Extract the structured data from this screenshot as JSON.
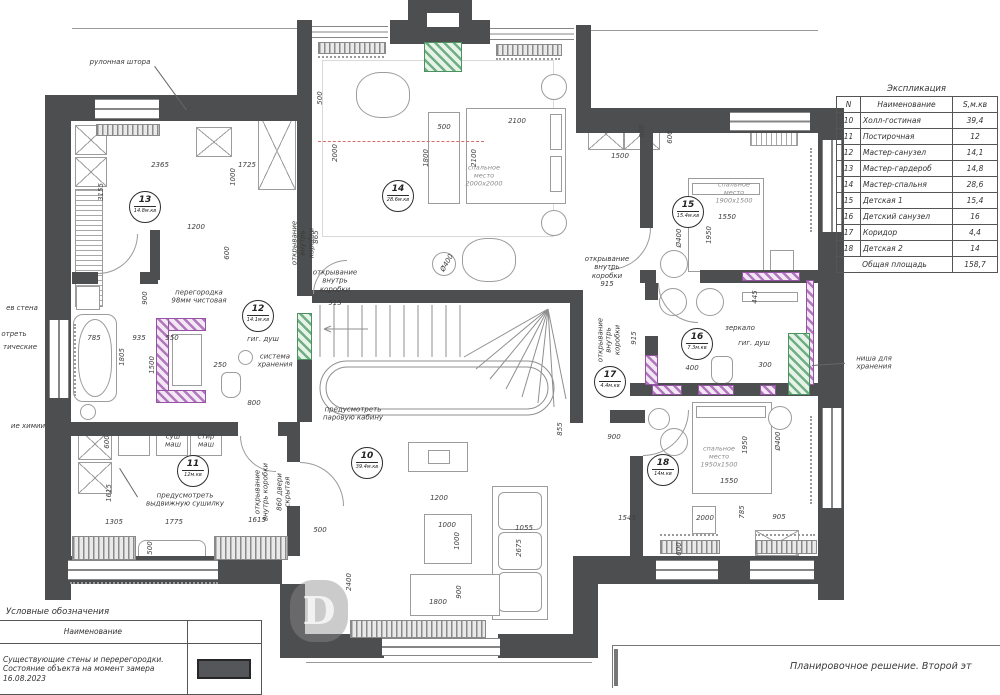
{
  "colors": {
    "wall": "#4d4e50",
    "new_partition": "#9454a3",
    "niche_green": "#4c9160",
    "centerline_red": "#d96b6b"
  },
  "explication": {
    "title": "Экспликация",
    "headers": [
      "N",
      "Наименование",
      "S,м.кв"
    ],
    "rows": [
      [
        "10",
        "Холл-гостиная",
        "39,4"
      ],
      [
        "11",
        "Постирочная",
        "12"
      ],
      [
        "12",
        "Мастер-санузел",
        "14,1"
      ],
      [
        "13",
        "Мастер-гардероб",
        "14,8"
      ],
      [
        "14",
        "Мастер-спальня",
        "28,6"
      ],
      [
        "15",
        "Детская 1",
        "15,4"
      ],
      [
        "16",
        "Детский санузел",
        "16"
      ],
      [
        "17",
        "Коридор",
        "4,4"
      ],
      [
        "18",
        "Детская 2",
        "14"
      ]
    ],
    "total_label": "Общая площадь",
    "total_value": "158,7"
  },
  "symbols_legend": {
    "title": "Условные обозначения",
    "header": "Наименование",
    "row_text": "Существующие стены и перерегородки. Состояние объекта на момент замера 16.08.2023"
  },
  "title_block": {
    "text": "Планировочное решение. Второй эт"
  },
  "plan": {
    "rooms": [
      {
        "n": "13",
        "a": "14.8м.кв",
        "x": 145,
        "y": 207
      },
      {
        "n": "12",
        "a": "14.1м.кв",
        "x": 258,
        "y": 316
      },
      {
        "n": "14",
        "a": "28.6м.кв",
        "x": 398,
        "y": 196
      },
      {
        "n": "15",
        "a": "15.4м.кв",
        "x": 688,
        "y": 212
      },
      {
        "n": "16",
        "a": "7.3м.кв",
        "x": 697,
        "y": 344
      },
      {
        "n": "17",
        "a": "4.4м.кв",
        "x": 610,
        "y": 382
      },
      {
        "n": "10",
        "a": "39.4м.кв",
        "x": 367,
        "y": 463
      },
      {
        "n": "11",
        "a": "12м.кв",
        "x": 193,
        "y": 471
      },
      {
        "n": "18",
        "a": "14м.кв",
        "x": 663,
        "y": 470
      }
    ],
    "annotations": [
      {
        "t": "рулонная штора",
        "x": 120,
        "y": 62
      },
      {
        "t": "перегородка\n98мм чистовая",
        "x": 199,
        "y": 297
      },
      {
        "t": "гиг. душ",
        "x": 263,
        "y": 339
      },
      {
        "t": "система\nхранения",
        "x": 275,
        "y": 361
      },
      {
        "t": "предусмотреть\nпаровую кабину",
        "x": 353,
        "y": 414
      },
      {
        "t": "открывание\nвнутрь\nкоробки",
        "x": 335,
        "y": 281
      },
      {
        "t": "открывание\nвнутрь\nкоробки",
        "x": 303,
        "y": 243,
        "rot": -90
      },
      {
        "t": "открывание\nвнутрь\nкоробки\n915",
        "x": 607,
        "y": 272
      },
      {
        "t": "открывание\nвнутрь\nкоробки",
        "x": 609,
        "y": 340,
        "rot": -90
      },
      {
        "t": "зеркало",
        "x": 740,
        "y": 328
      },
      {
        "t": "гиг. душ",
        "x": 754,
        "y": 343
      },
      {
        "t": "ниша для\nхранения",
        "x": 874,
        "y": 363
      },
      {
        "t": "спальное\nместо\n2000х2000",
        "x": 484,
        "y": 176,
        "dim": 1
      },
      {
        "t": "спальное\nместо\n1900х1500",
        "x": 734,
        "y": 193,
        "dim": 1
      },
      {
        "t": "спальное\nместо\n1950х1500",
        "x": 719,
        "y": 457,
        "dim": 1
      },
      {
        "t": "суш\nмаш",
        "x": 173,
        "y": 441
      },
      {
        "t": "стир\nмаш",
        "x": 206,
        "y": 441
      },
      {
        "t": "предусмотреть\nвыдвижную сушилку",
        "x": 185,
        "y": 500
      },
      {
        "t": "открывание\nвнутрь коробки",
        "x": 262,
        "y": 492,
        "rot": -90
      },
      {
        "t": "860 двери\nскрытая",
        "x": 284,
        "y": 492,
        "rot": -90
      },
      {
        "t": "ев стена",
        "x": 22,
        "y": 308
      },
      {
        "t": "отреть",
        "x": 14,
        "y": 334
      },
      {
        "t": "тические",
        "x": 20,
        "y": 347
      },
      {
        "t": "ие химии",
        "x": 28,
        "y": 426
      },
      {
        "t": "Ø400",
        "x": 447,
        "y": 263,
        "rot": -60
      },
      {
        "t": "Ø400",
        "x": 679,
        "y": 238,
        "rot": -90
      },
      {
        "t": "Ø400",
        "x": 778,
        "y": 441,
        "rot": -90
      }
    ],
    "dimensions": [
      {
        "t": "2365",
        "x": 160,
        "y": 165
      },
      {
        "t": "1725",
        "x": 247,
        "y": 165
      },
      {
        "t": "3155",
        "x": 101,
        "y": 192,
        "r": 1
      },
      {
        "t": "1000",
        "x": 233,
        "y": 177,
        "r": 1
      },
      {
        "t": "1200",
        "x": 196,
        "y": 227
      },
      {
        "t": "600",
        "x": 227,
        "y": 253,
        "r": 1
      },
      {
        "t": "500",
        "x": 320,
        "y": 98,
        "r": 1
      },
      {
        "t": "2000",
        "x": 335,
        "y": 153,
        "r": 1
      },
      {
        "t": "500",
        "x": 444,
        "y": 127
      },
      {
        "t": "2100",
        "x": 517,
        "y": 121
      },
      {
        "t": "1800",
        "x": 426,
        "y": 158,
        "r": 1
      },
      {
        "t": "2100",
        "x": 474,
        "y": 158,
        "r": 1
      },
      {
        "t": "1500",
        "x": 620,
        "y": 156
      },
      {
        "t": "500",
        "x": 642,
        "y": 131,
        "r": 1
      },
      {
        "t": "600",
        "x": 670,
        "y": 137,
        "r": 1
      },
      {
        "t": "1550",
        "x": 727,
        "y": 217
      },
      {
        "t": "1950",
        "x": 709,
        "y": 235,
        "r": 1
      },
      {
        "t": "445",
        "x": 755,
        "y": 297,
        "r": 1
      },
      {
        "t": "400",
        "x": 692,
        "y": 368
      },
      {
        "t": "300",
        "x": 765,
        "y": 365
      },
      {
        "t": "915",
        "x": 634,
        "y": 338,
        "r": 1
      },
      {
        "t": "1545",
        "x": 627,
        "y": 518
      },
      {
        "t": "2000",
        "x": 705,
        "y": 518
      },
      {
        "t": "905",
        "x": 779,
        "y": 517
      },
      {
        "t": "1550",
        "x": 729,
        "y": 481
      },
      {
        "t": "1950",
        "x": 745,
        "y": 445,
        "r": 1
      },
      {
        "t": "785",
        "x": 742,
        "y": 512,
        "r": 1
      },
      {
        "t": "600",
        "x": 679,
        "y": 549,
        "r": 1
      },
      {
        "t": "1200",
        "x": 439,
        "y": 498
      },
      {
        "t": "1000",
        "x": 447,
        "y": 525
      },
      {
        "t": "1000",
        "x": 457,
        "y": 541,
        "r": 1
      },
      {
        "t": "1055",
        "x": 524,
        "y": 528
      },
      {
        "t": "2675",
        "x": 519,
        "y": 548,
        "r": 1
      },
      {
        "t": "900",
        "x": 459,
        "y": 592,
        "r": 1
      },
      {
        "t": "1800",
        "x": 438,
        "y": 602
      },
      {
        "t": "500",
        "x": 320,
        "y": 530
      },
      {
        "t": "2400",
        "x": 349,
        "y": 582,
        "r": 1
      },
      {
        "t": "855",
        "x": 560,
        "y": 429,
        "r": 1
      },
      {
        "t": "900",
        "x": 614,
        "y": 437
      },
      {
        "t": "600",
        "x": 107,
        "y": 442,
        "r": 1
      },
      {
        "t": "1615",
        "x": 109,
        "y": 493,
        "r": 1
      },
      {
        "t": "1305",
        "x": 114,
        "y": 522
      },
      {
        "t": "1775",
        "x": 174,
        "y": 522
      },
      {
        "t": "1615",
        "x": 257,
        "y": 520
      },
      {
        "t": "500",
        "x": 150,
        "y": 548,
        "r": 1
      },
      {
        "t": "785",
        "x": 94,
        "y": 338
      },
      {
        "t": "935",
        "x": 139,
        "y": 338
      },
      {
        "t": "550",
        "x": 172,
        "y": 338
      },
      {
        "t": "1500",
        "x": 152,
        "y": 365,
        "r": 1
      },
      {
        "t": "1805",
        "x": 122,
        "y": 357,
        "r": 1
      },
      {
        "t": "250",
        "x": 220,
        "y": 365
      },
      {
        "t": "900",
        "x": 145,
        "y": 298,
        "r": 1
      },
      {
        "t": "915",
        "x": 335,
        "y": 303
      },
      {
        "t": "800",
        "x": 254,
        "y": 403
      },
      {
        "t": "865",
        "x": 316,
        "y": 237,
        "r": 1
      }
    ]
  }
}
